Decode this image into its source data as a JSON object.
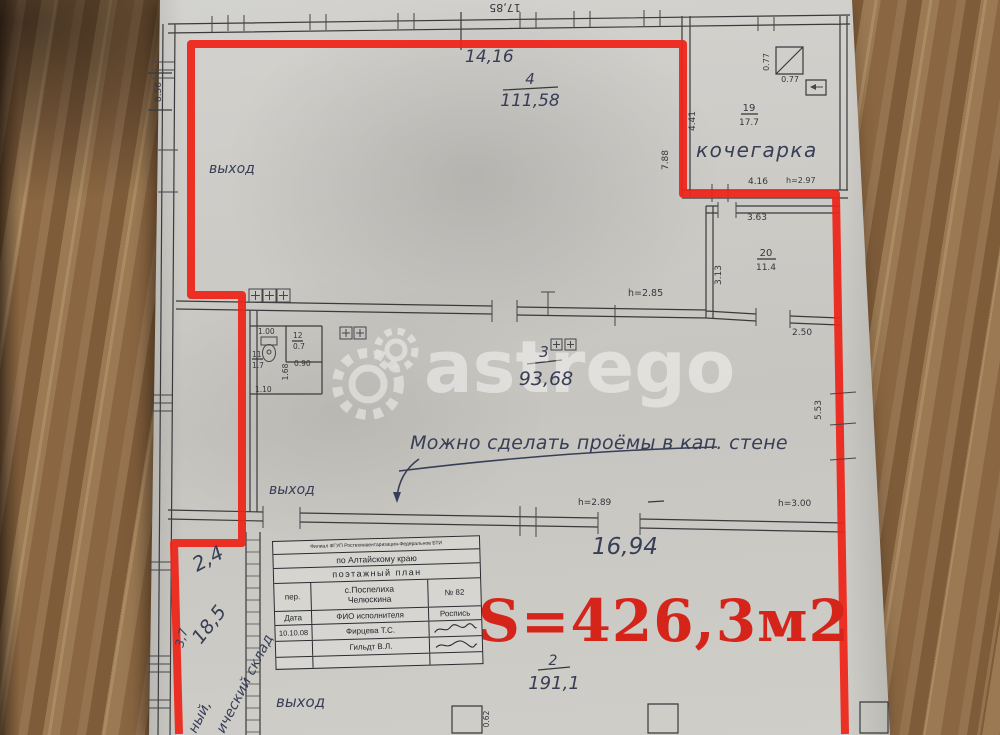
{
  "colors": {
    "outline_red": "#ee2418",
    "area_red": "#d5251a",
    "ink": "#35373d",
    "pen": "#373e56"
  },
  "watermark": {
    "text": "astrego"
  },
  "area_label": "S=426,3м2",
  "dims": {
    "top_outer": "17,85",
    "left_outer": "8.56",
    "room4_width": "14,16",
    "room4_height_mark": "h=2.85",
    "boiler_left": "4.41",
    "boiler_wall": "7.88",
    "boiler_width": "4.16",
    "boiler_height_mark": "h=2.97",
    "chimney_side": "0.77",
    "chimney_bottom": "0.77",
    "room20_top": "3.63",
    "room20_left": "3.13",
    "room20_bottom": "2.50",
    "room3_height_mark1": "h=2.89",
    "room3_height_mark2": "h=3.00",
    "room3_right": "5.53",
    "room3_bottom": "16,94",
    "wc_top": "1.00",
    "wc_side": "1.68",
    "wc_bottom": "1.10",
    "room12_bottom": "0.90",
    "column": "0.62",
    "shed_1": "2,4",
    "shed_2": "18,5",
    "shed_3": "3,7"
  },
  "rooms": {
    "room4": {
      "number": "4",
      "area": "111,58"
    },
    "boiler": {
      "name": "кочегарка",
      "number": "19",
      "area": "17.7"
    },
    "room20": {
      "number": "20",
      "area": "11.4"
    },
    "room3": {
      "number": "3",
      "area": "93,68"
    },
    "wc": {
      "number": "11",
      "area": "1.7"
    },
    "room12": {
      "number": "12",
      "area": "0.7"
    },
    "room2": {
      "number": "2",
      "area": "191,1"
    }
  },
  "annotations": {
    "exit_top": "выход",
    "exit_mid": "выход",
    "exit_bottom": "выход",
    "note": "Можно сделать проёмы в кап. стене",
    "shed_text_1": "ный,",
    "shed_text_2": "ический склад"
  },
  "stamp": {
    "org_line": "Филиал ФГУП Ростехинвентаризация-Федеральное БТИ",
    "region": "по Алтайскому краю",
    "doc_type": "поэтажный план",
    "street_label": "пер.",
    "settlement": "с.Поспелиха",
    "street": "Челюскина",
    "house_no": "№ 82",
    "date_label": "Дата",
    "executor_label": "ФИО исполнителя",
    "signature_label": "Роспись",
    "date": "10.10.08",
    "executor1": "Фирцева Т.С.",
    "executor2": "Гильдт В.Л."
  }
}
